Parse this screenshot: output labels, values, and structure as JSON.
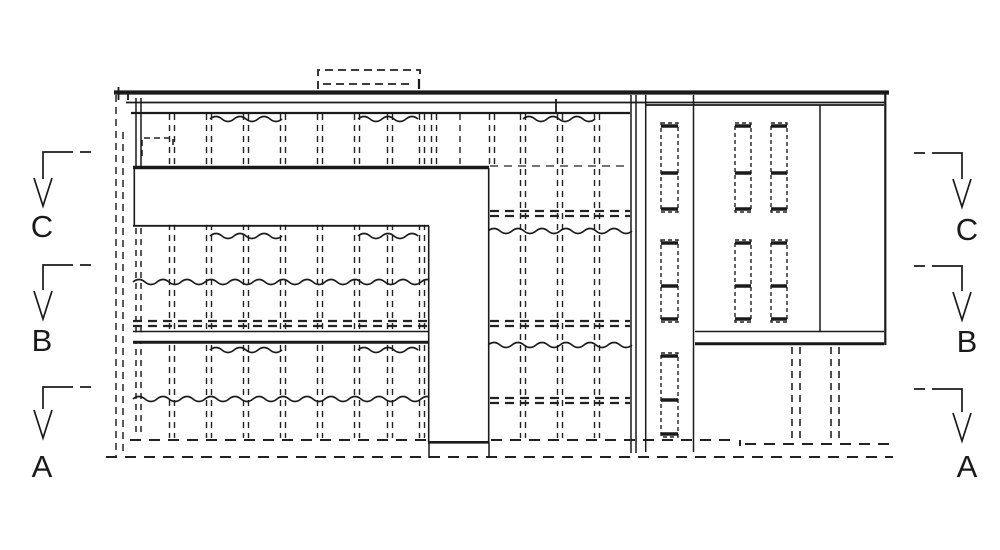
{
  "drawing": {
    "type": "architectural-elevation",
    "colors": {
      "ink": "#1a1a1a",
      "paper": "#ffffff"
    }
  },
  "section_markers": {
    "left": [
      {
        "label": "C"
      },
      {
        "label": "B"
      },
      {
        "label": "A"
      }
    ],
    "right": [
      {
        "label": "C"
      },
      {
        "label": "B"
      },
      {
        "label": "A"
      }
    ]
  }
}
